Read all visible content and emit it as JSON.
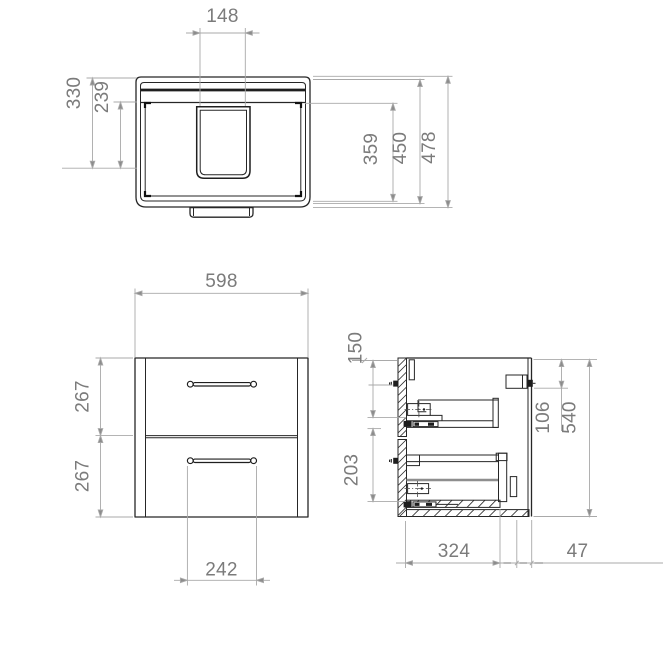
{
  "top_view": {
    "dims": {
      "cutout_width": "148",
      "back_depth": "330",
      "basin_depth": "239",
      "front_depth": "359",
      "inner_depth": "450",
      "overall_depth": "478"
    }
  },
  "front_view": {
    "dims": {
      "overall_width": "598",
      "upper_drawer_height": "267",
      "lower_drawer_height": "267",
      "handle_spacing": "242"
    }
  },
  "side_view": {
    "dims": {
      "top_fixing_offset": "150",
      "lower_fixing_offset": "203",
      "hanger_offset": "106",
      "overall_height": "540",
      "inner_depth": "324",
      "back_clearance": "47"
    }
  }
}
